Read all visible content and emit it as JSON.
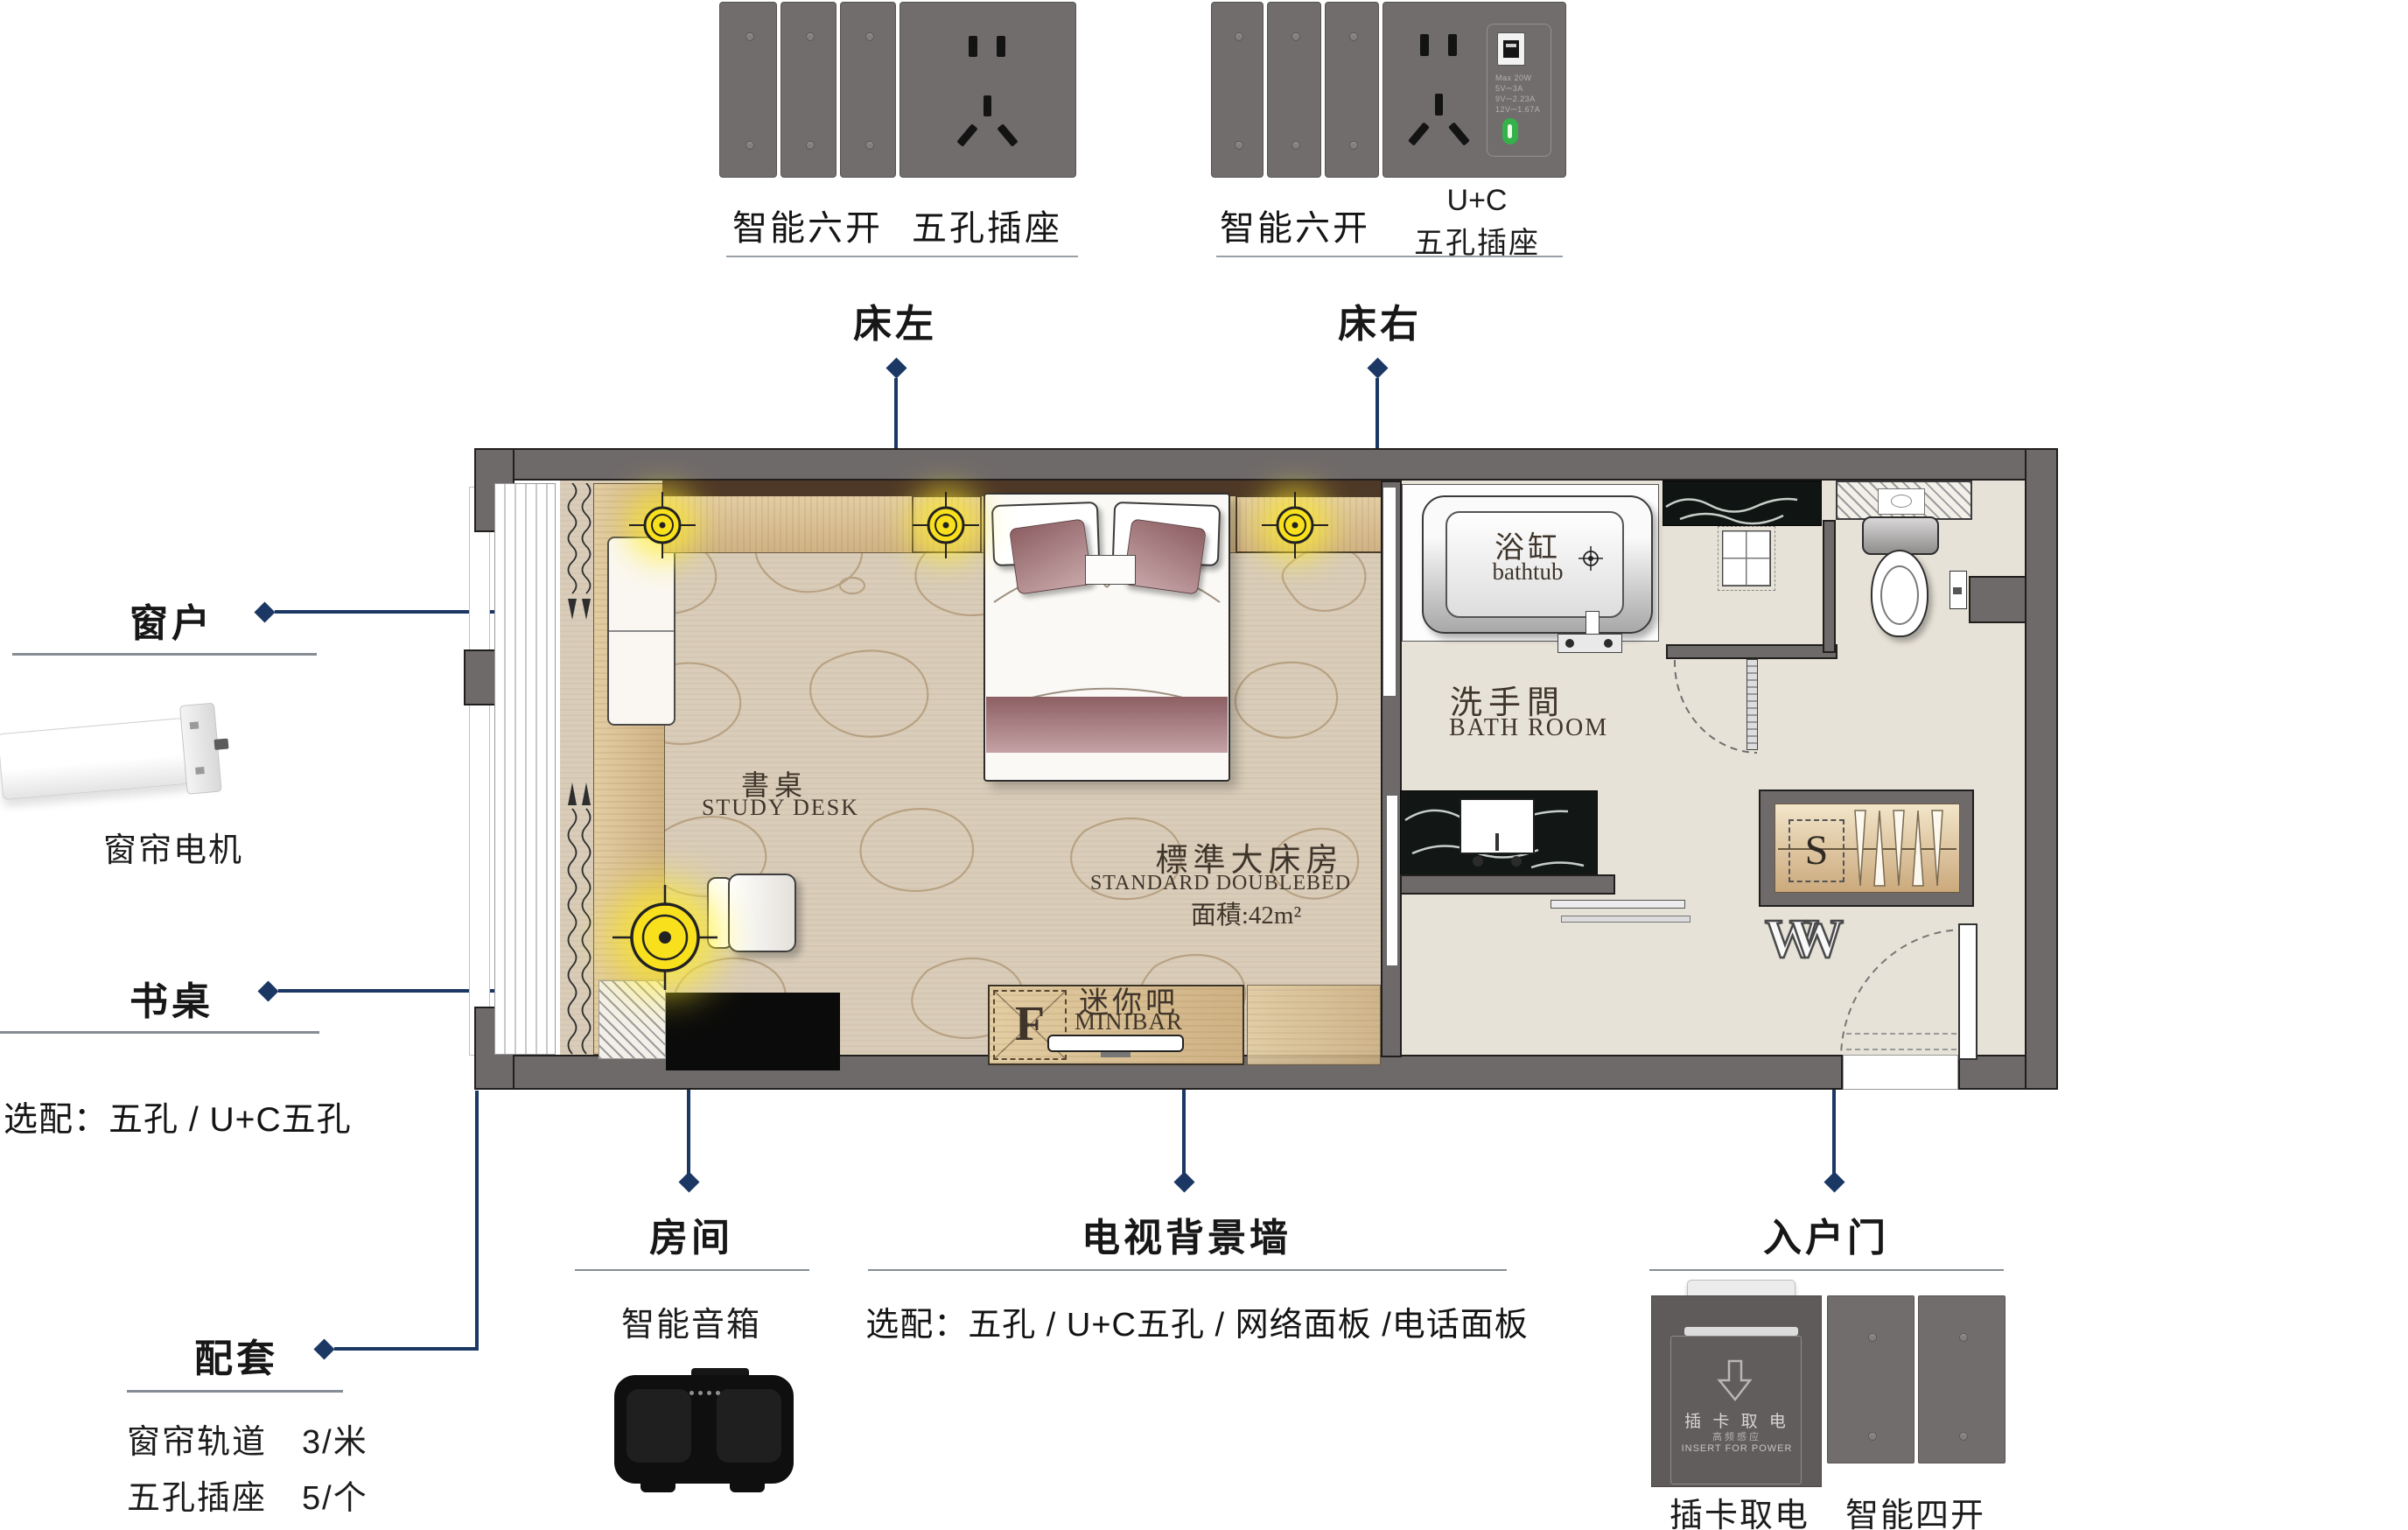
{
  "palette": {
    "navy": "#1b3864",
    "wall_gray": "#6f6a6a",
    "panel_gray": "#716d6d",
    "accent_yellow": "#ffe92e",
    "usb_green": "#35b14a"
  },
  "top_products": {
    "bed_left": {
      "switch_label": "智能六开",
      "socket_label": "五孔插座",
      "callout": "床左"
    },
    "bed_right": {
      "switch_label": "智能六开",
      "socket_label_top": "U+C",
      "socket_label_bottom": "五孔插座",
      "callout": "床右",
      "usb_specs": [
        "Max 20W",
        "5V⎓3A",
        "9V⎓2.23A",
        "12V⎓1.67A"
      ]
    }
  },
  "left_callouts": {
    "window": {
      "title": "窗户",
      "product_label": "窗帘电机"
    },
    "desk": {
      "title": "书桌",
      "option_note": "选配：五孔 / U+C五孔"
    },
    "bundle": {
      "title": "配套",
      "items": [
        "窗帘轨道　3/米",
        "五孔插座　5/个"
      ]
    }
  },
  "bottom_callouts": {
    "room": {
      "title": "房间",
      "product_label": "智能音箱"
    },
    "tv_wall": {
      "title": "电视背景墙",
      "option_note": "选配：五孔 / U+C五孔 / 网络面板 /电话面板"
    },
    "entry": {
      "title": "入户门",
      "product_label_1": "插卡取电",
      "product_label_2": "智能四开"
    }
  },
  "floor_plan": {
    "room_name_zh": "標準大床房",
    "room_name_en": "STANDARD  DOUBLEBED",
    "room_area": "面積:42m²",
    "study_desk_zh": "書桌",
    "study_desk_en": "STUDY DESK",
    "minibar_zh": "迷你吧",
    "minibar_en": "MINIBAR",
    "fridge_mark": "F",
    "bathtub_zh": "浴缸",
    "bathtub_en": "bathtub",
    "bathroom_zh": "洗手間",
    "bathroom_en": "BATH ROOM",
    "safe_mark": "S",
    "wardrobe_mark": "W"
  },
  "card_switch_panel": {
    "line_zh": "插 卡 取 电",
    "line_sub": "高频感应",
    "line_en": "INSERT FOR POWER"
  }
}
